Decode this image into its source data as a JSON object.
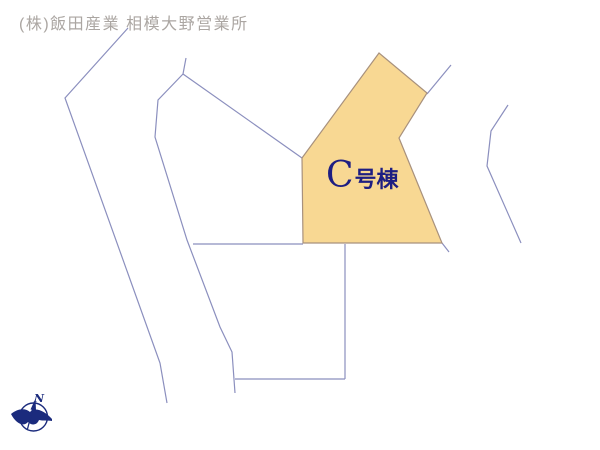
{
  "header": {
    "company": "(株)飯田産業 相模大野営業所"
  },
  "lot": {
    "letter": "C",
    "suffix": "号棟",
    "full_label": "C号棟"
  },
  "compass": {
    "label": "N"
  },
  "colors": {
    "background": "#ffffff",
    "boundary_line": "#8b8fbe",
    "lot_fill": "#f8d893",
    "lot_border": "#a8917d",
    "lot_label": "#1e1e82",
    "header_text": "#aba6a2",
    "compass": "#1b2b7d"
  },
  "geometry": {
    "lot_polygon": [
      [
        379,
        53
      ],
      [
        427,
        93
      ],
      [
        399,
        138
      ],
      [
        442,
        243
      ],
      [
        303,
        243
      ],
      [
        302,
        158
      ]
    ],
    "boundary_lines": [
      {
        "name": "west-boundary",
        "points": [
          [
            128,
            28
          ],
          [
            65,
            98
          ],
          [
            160,
            363
          ],
          [
            167,
            403
          ]
        ]
      },
      {
        "name": "center-west-boundary",
        "points": [
          [
            186,
            58
          ],
          [
            183,
            74
          ],
          [
            158,
            100
          ],
          [
            155,
            137
          ],
          [
            187,
            240
          ],
          [
            220,
            327
          ],
          [
            232,
            352
          ],
          [
            235,
            393
          ]
        ]
      },
      {
        "name": "road-edge",
        "points": [
          [
            183,
            74
          ],
          [
            302,
            158
          ]
        ]
      },
      {
        "name": "north-stub",
        "points": [
          [
            451,
            65
          ],
          [
            427,
            94
          ]
        ]
      },
      {
        "name": "east-boundary",
        "points": [
          [
            508,
            105
          ],
          [
            491,
            131
          ],
          [
            487,
            166
          ],
          [
            521,
            243
          ]
        ]
      },
      {
        "name": "lot-corner-tail",
        "points": [
          [
            442,
            243
          ],
          [
            449,
            252
          ]
        ]
      },
      {
        "name": "south-lot-top",
        "points": [
          [
            193,
            244
          ],
          [
            303,
            244
          ]
        ]
      },
      {
        "name": "south-lot-east",
        "points": [
          [
            345,
            244
          ],
          [
            345,
            379
          ]
        ]
      },
      {
        "name": "south-lot-bottom",
        "points": [
          [
            235,
            379
          ],
          [
            345,
            379
          ]
        ]
      }
    ]
  }
}
